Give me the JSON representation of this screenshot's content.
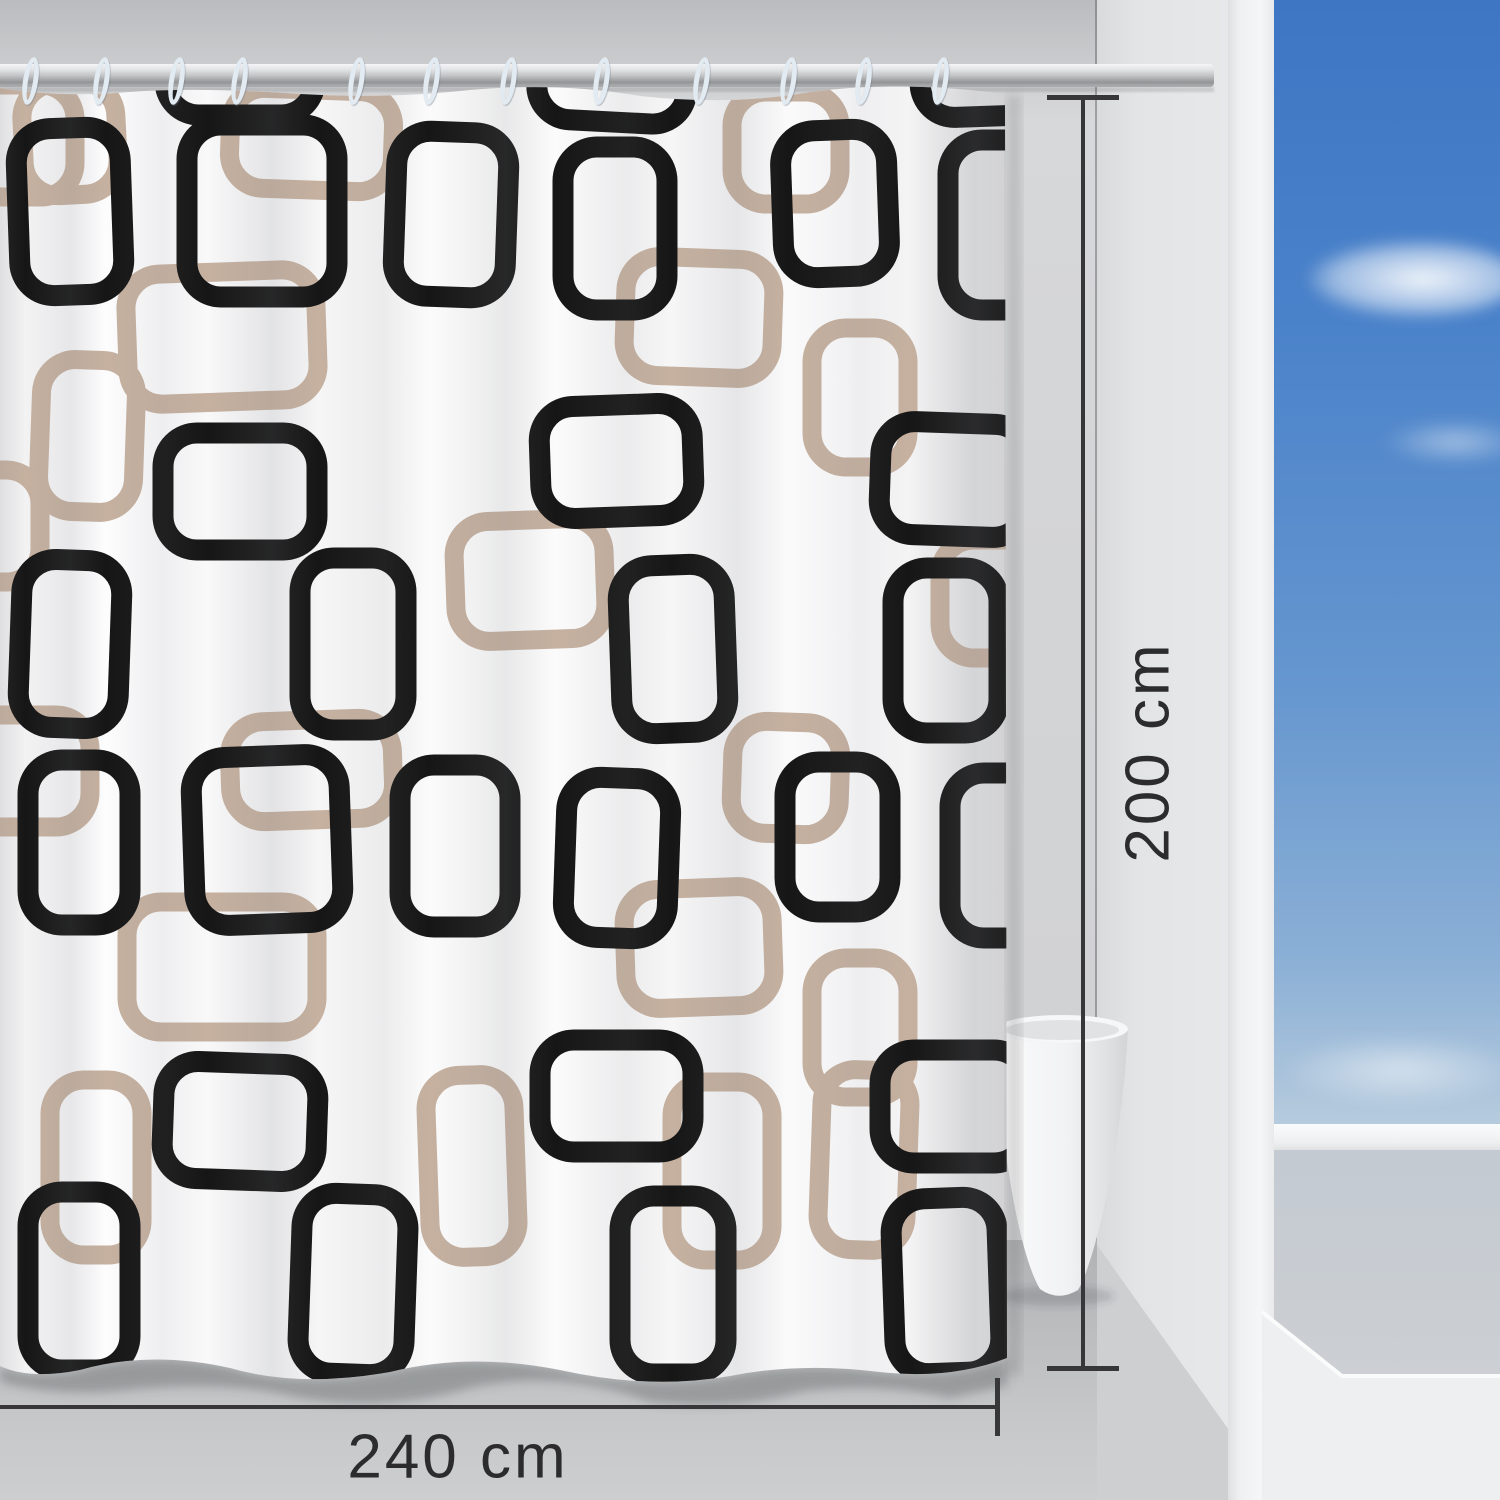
{
  "dimensions": {
    "height_label": "200 cm",
    "width_label": "240 cm"
  },
  "rings": {
    "count": 12,
    "x_positions": [
      30,
      101,
      176,
      239,
      356,
      431,
      508,
      601,
      701,
      788,
      863,
      940
    ]
  },
  "curtain_pattern": {
    "black_color": "#161616",
    "tan_color": "#c6b1a0",
    "black_stroke_width": 21,
    "tan_stroke_width": 19,
    "corner_radius": 34,
    "black_rects": [
      [
        18,
        128,
        104,
        167,
        -2
      ],
      [
        187,
        125,
        150,
        172,
        0
      ],
      [
        395,
        132,
        112,
        165,
        2
      ],
      [
        563,
        147,
        104,
        163,
        0
      ],
      [
        782,
        130,
        106,
        147,
        -2
      ],
      [
        948,
        140,
        108,
        170,
        0
      ],
      [
        165,
        -75,
        150,
        190,
        0
      ],
      [
        540,
        -70,
        150,
        192,
        3
      ],
      [
        918,
        -72,
        148,
        188,
        -2
      ],
      [
        163,
        433,
        154,
        117,
        0
      ],
      [
        540,
        405,
        153,
        112,
        -2
      ],
      [
        880,
        423,
        148,
        113,
        2
      ],
      [
        20,
        560,
        100,
        168,
        2
      ],
      [
        300,
        558,
        106,
        172,
        0
      ],
      [
        620,
        565,
        106,
        168,
        -2
      ],
      [
        893,
        568,
        106,
        165,
        0
      ],
      [
        28,
        760,
        102,
        165,
        0
      ],
      [
        193,
        756,
        148,
        168,
        -2
      ],
      [
        400,
        765,
        110,
        162,
        0
      ],
      [
        565,
        778,
        104,
        160,
        2
      ],
      [
        785,
        762,
        105,
        150,
        0
      ],
      [
        950,
        773,
        105,
        165,
        0
      ],
      [
        163,
        1063,
        154,
        117,
        2
      ],
      [
        540,
        1040,
        153,
        112,
        0
      ],
      [
        880,
        1050,
        148,
        113,
        0
      ],
      [
        28,
        1192,
        102,
        178,
        0
      ],
      [
        300,
        1194,
        106,
        180,
        2
      ],
      [
        620,
        1196,
        106,
        178,
        0
      ],
      [
        893,
        1198,
        106,
        175,
        -2
      ]
    ],
    "tan_rects": [
      [
        -75,
        85,
        150,
        112,
        0
      ],
      [
        23,
        83,
        94,
        112,
        -3
      ],
      [
        230,
        90,
        163,
        100,
        2
      ],
      [
        732,
        92,
        108,
        112,
        0
      ],
      [
        127,
        272,
        190,
        130,
        -2
      ],
      [
        625,
        258,
        148,
        119,
        2
      ],
      [
        812,
        328,
        96,
        139,
        0
      ],
      [
        40,
        360,
        95,
        152,
        2
      ],
      [
        -70,
        470,
        110,
        112,
        0
      ],
      [
        455,
        520,
        150,
        120,
        -2
      ],
      [
        940,
        540,
        110,
        118,
        0
      ],
      [
        -60,
        715,
        150,
        112,
        0
      ],
      [
        230,
        720,
        163,
        100,
        -2
      ],
      [
        732,
        722,
        108,
        112,
        2
      ],
      [
        127,
        902,
        190,
        130,
        0
      ],
      [
        625,
        888,
        148,
        119,
        -2
      ],
      [
        812,
        958,
        96,
        139,
        0
      ],
      [
        50,
        1080,
        92,
        175,
        0
      ],
      [
        428,
        1075,
        88,
        182,
        -2
      ],
      [
        672,
        1082,
        100,
        178,
        0
      ],
      [
        820,
        1070,
        88,
        180,
        2
      ]
    ]
  },
  "colors": {
    "sky_blue": "#4a82ca",
    "wall_gray": "#d3d4d6",
    "floor_gray": "#c0c1c3",
    "annotation": "#37373a",
    "ring": "#e2ebf2",
    "curtain_white": "#fcfcfd"
  }
}
